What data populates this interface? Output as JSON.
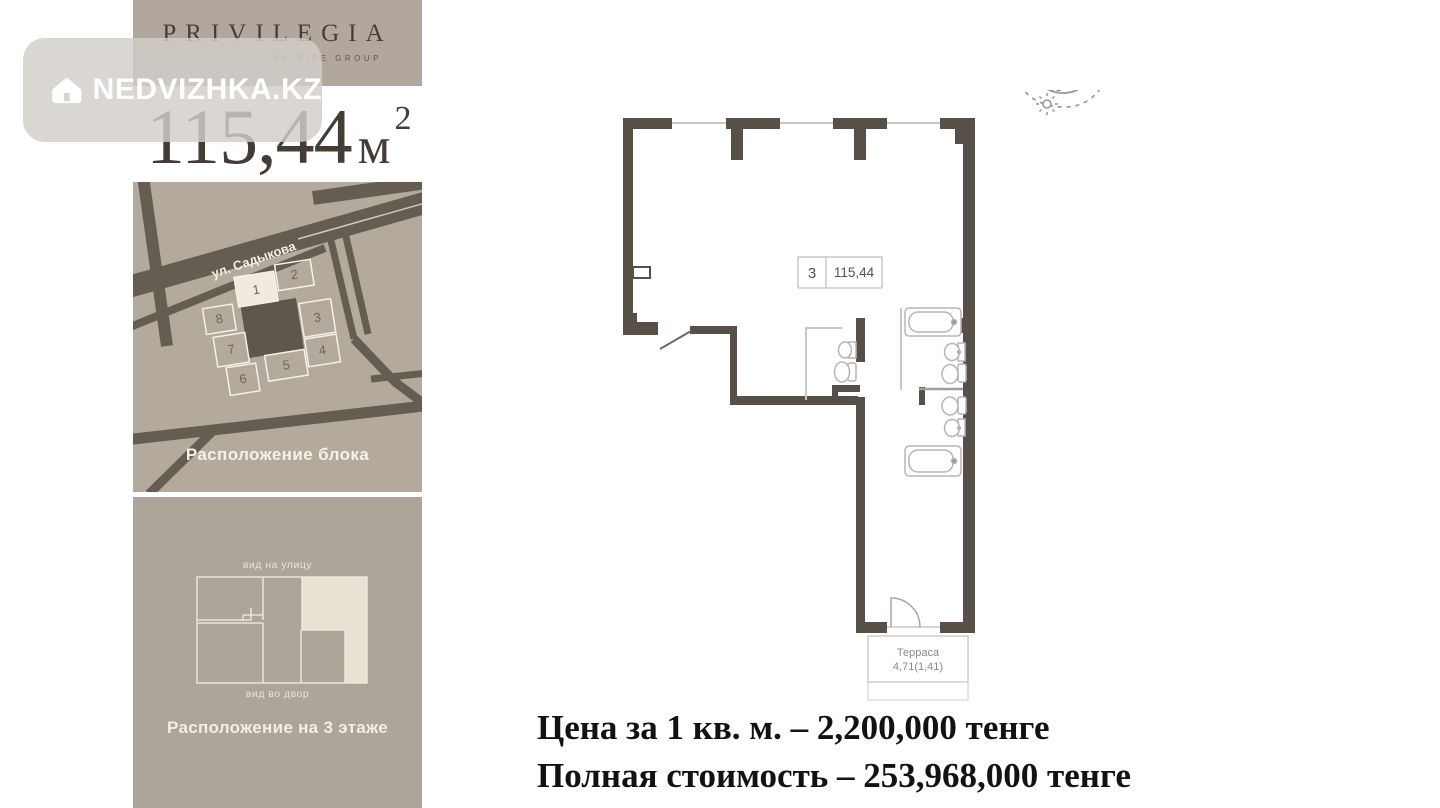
{
  "watermark": {
    "brand": "NEDVIZHKA.KZ"
  },
  "brand": {
    "name": "PRIVILEGIA",
    "subtitle": "BY RISE GROUP"
  },
  "area": {
    "value": "115,44",
    "unit": "м",
    "power": "2"
  },
  "map": {
    "street": "ул. Садыкова",
    "caption": "Расположение блока",
    "blocks": [
      "1",
      "2",
      "3",
      "4",
      "5",
      "6",
      "7",
      "8"
    ],
    "highlighted_block": "1"
  },
  "floor": {
    "street_side": "вид на улицу",
    "yard_side": "вид во двор",
    "caption": "Расположение на 3 этаже"
  },
  "plan": {
    "unit_number": "3",
    "unit_area": "115,44",
    "terrace_name": "Терраса",
    "terrace_area": "4,71(1,41)",
    "compass": {
      "north": "С",
      "east": "В",
      "south": "Ю",
      "west": "З"
    }
  },
  "pricing": {
    "per_m2": "Цена за 1 кв. м. – 2,200,000 тенге",
    "total": "Полная стоимость – 253,968,000 тенге"
  },
  "colors": {
    "card_taupe": "#b1a79c",
    "road": "#665d52",
    "wall": "#575049",
    "highlight_cream": "#f0e9dc"
  }
}
